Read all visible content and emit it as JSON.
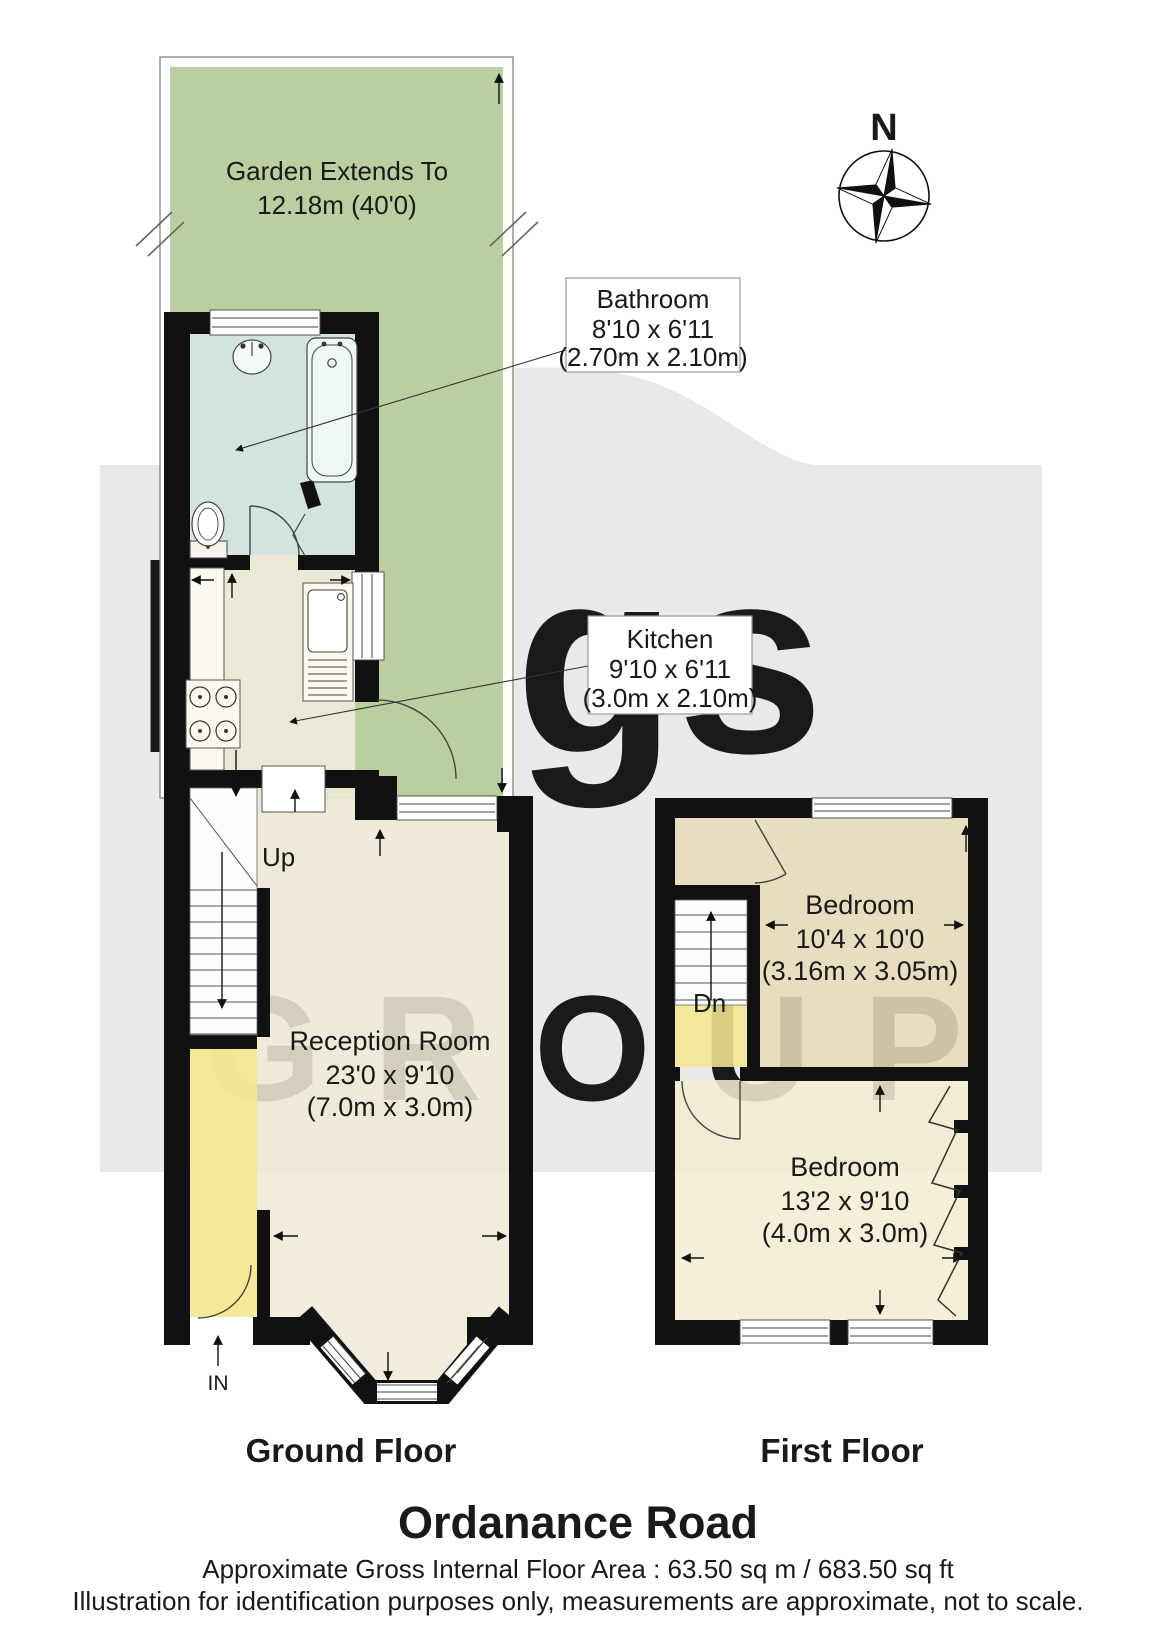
{
  "title": "Ordanance Road",
  "footer": {
    "area": "Approximate Gross Internal Floor Area : 63.50 sq m / 683.50 sq ft",
    "disclaimer": "Illustration for identification purposes only, measurements are approximate, not to scale."
  },
  "floors": {
    "ground": {
      "label": "Ground Floor"
    },
    "first": {
      "label": "First Floor"
    }
  },
  "compass": {
    "north": "N"
  },
  "watermark": {
    "line1": "kings",
    "line2": "GROUP"
  },
  "garden": {
    "line1": "Garden Extends To",
    "line2": "12.18m (40'0)"
  },
  "rooms": {
    "bathroom": {
      "name": "Bathroom",
      "imperial": "8'10 x 6'11",
      "metric": "(2.70m x 2.10m)"
    },
    "kitchen": {
      "name": "Kitchen",
      "imperial": "9'10 x 6'11",
      "metric": "(3.0m x 2.10m)"
    },
    "reception": {
      "name": "Reception Room",
      "imperial": "23'0 x 9'10",
      "metric": "(7.0m x 3.0m)"
    },
    "bedroom1": {
      "name": "Bedroom",
      "imperial": "10'4 x 10'0",
      "metric": "(3.16m x 3.05m)"
    },
    "bedroom2": {
      "name": "Bedroom",
      "imperial": "13'2 x 9'10",
      "metric": "(4.0m x 3.0m)"
    }
  },
  "stairs": {
    "up": "Up",
    "down": "Dn"
  },
  "entrance": {
    "label": "IN"
  },
  "colors": {
    "background": "#e9e9e9",
    "walls": "#111111",
    "garden": "#b4c996",
    "bathroom": "#d7e7e8",
    "kitchen": "#f2ecdc",
    "reception": "#f0e9d7",
    "hallway": "#f5e88d",
    "bedroom1": "#e8ddb9",
    "bedroom2": "#f3ecd3",
    "watermark": "#ffffff"
  }
}
